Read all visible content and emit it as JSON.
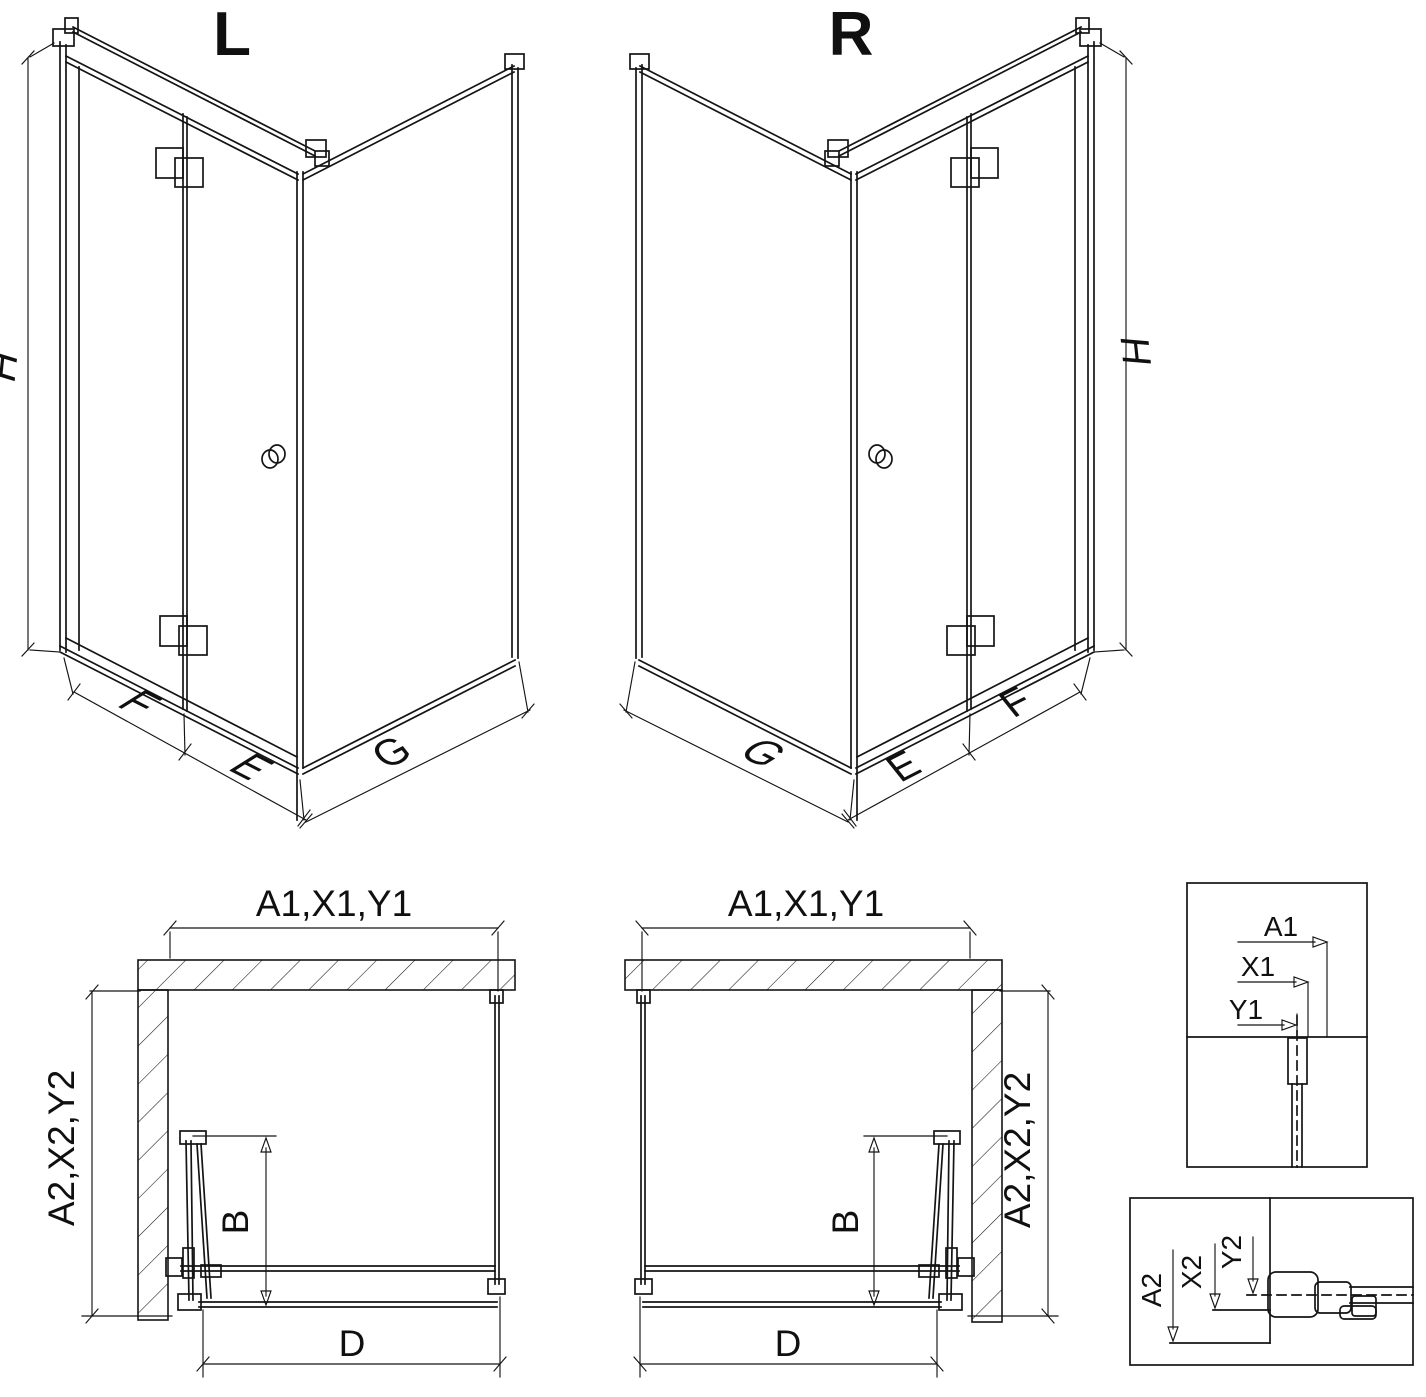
{
  "colors": {
    "line": "#141414",
    "background": "#ffffff"
  },
  "iso_views": {
    "left": {
      "variant_label": "L",
      "height_dim": "H",
      "door_fold_dim": "F",
      "door_edge_dim": "E",
      "side_panel_dim": "G"
    },
    "right": {
      "variant_label": "R",
      "height_dim": "H",
      "door_fold_dim": "F",
      "door_edge_dim": "E",
      "side_panel_dim": "G"
    }
  },
  "plan_views": {
    "left": {
      "top_dim": "A1,X1,Y1",
      "side_dim": "A2,X2,Y2",
      "door_open_depth_dim": "B",
      "entry_width_dim": "D"
    },
    "right": {
      "top_dim": "A1,X1,Y1",
      "side_dim": "A2,X2,Y2",
      "door_open_depth_dim": "B",
      "entry_width_dim": "D"
    }
  },
  "detail_views": {
    "wall_profile": {
      "dim_a": "A1",
      "dim_x": "X1",
      "dim_y": "Y1"
    },
    "floor_profile": {
      "dim_a": "A2",
      "dim_x": "X2",
      "dim_y": "Y2"
    }
  }
}
